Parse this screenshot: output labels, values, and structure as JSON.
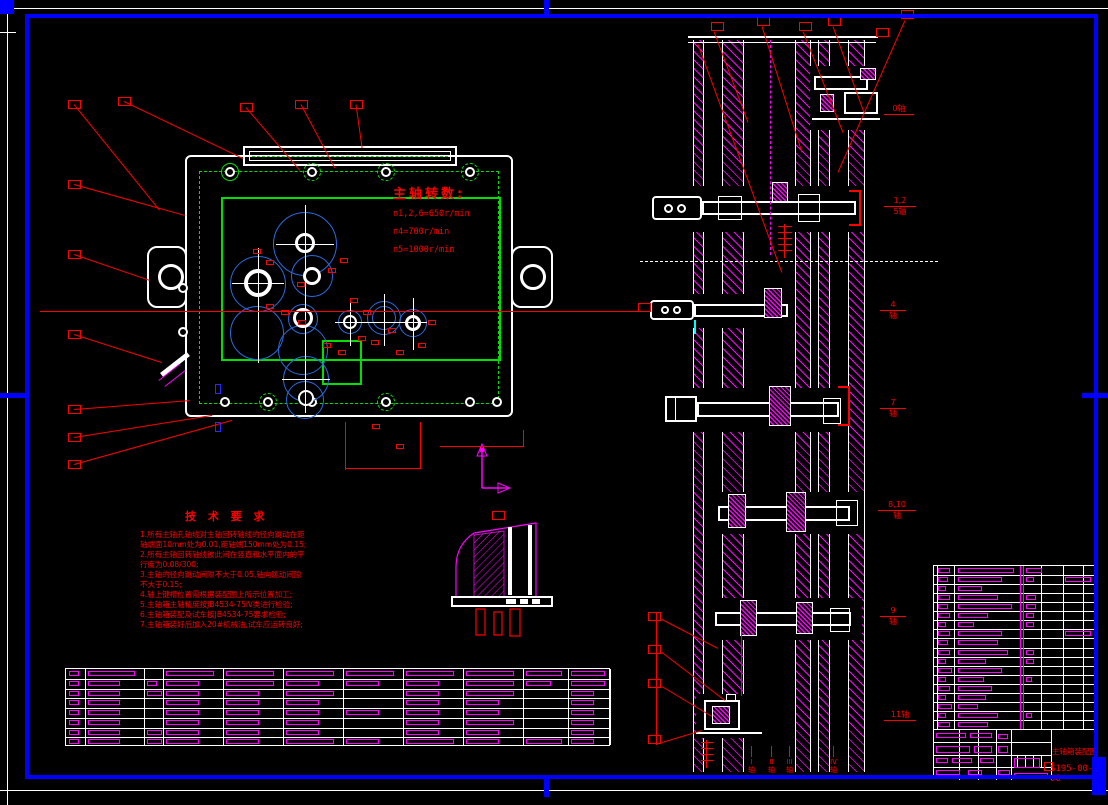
{
  "plan_view": {
    "speed_note": {
      "title": "主轴转数:",
      "lines": [
        "n1,2,6=650r/min",
        "n4=700r/min",
        "n5=1000r/min"
      ]
    }
  },
  "notes": {
    "title": "技 术 要 求",
    "lines": [
      "1.所有主轴孔轴线对主轴回转轴线的径向跳动在距",
      "轴端面10mm处为0.01,距轴端150mm处为0.15;",
      "2.所有主轴回转轴线彼此间在竖直和水平面内的平",
      "行度为0.08/300;",
      "3.主轴的径向跳动间隙不大于0.05,轴向跳动间隙",
      "不大于0.15;",
      "4.轴上键槽位置需根据装配图上所示位置加工;",
      "5.主轴箱主轴精度按JB4534-75Ⅳ类进行检验;",
      "6.主轴箱装配及试车按JB4534-75要求检验;",
      "7.主轴箱装好后加入20#机械油,试车应运转良好;"
    ]
  },
  "section_view": {
    "shaft_labels": [
      {
        "text": "0轴"
      },
      {
        "upper": "1,2",
        "lower": "5轴"
      },
      {
        "upper": "4",
        "lower": "轴"
      },
      {
        "upper": "7",
        "lower": "轴"
      },
      {
        "upper": "8,10",
        "lower": "轴"
      },
      {
        "upper": "9",
        "lower": "轴"
      },
      {
        "text": "11轴"
      }
    ],
    "bottom_labels": [
      {
        "num": "I",
        "word": "轴"
      },
      {
        "num": "II",
        "word": "轴"
      },
      {
        "num": "III",
        "word": "轴"
      },
      {
        "num": "IV",
        "word": "轴"
      }
    ]
  },
  "title_block": {
    "name": "主轴箱装配图",
    "number": "S195-00-00"
  },
  "colors": {
    "frame": "#0000ff",
    "outline": "#ffffff",
    "annotation": "#ff0000",
    "housing": "#00e000",
    "gears": "#2a6adf",
    "hatch": "#ff00ff",
    "highlight": "#00ffff"
  },
  "bom_table": {
    "rows": [
      [
        12,
        56,
        16,
        0
      ],
      [
        10,
        44,
        8,
        26
      ],
      [
        8,
        24,
        0,
        0
      ],
      [
        12,
        40,
        10,
        0
      ],
      [
        10,
        54,
        10,
        0
      ],
      [
        12,
        30,
        8,
        0
      ],
      [
        8,
        16,
        8,
        0
      ],
      [
        12,
        44,
        0,
        26
      ],
      [
        10,
        40,
        0,
        0
      ],
      [
        12,
        50,
        8,
        0
      ],
      [
        8,
        28,
        8,
        0
      ],
      [
        14,
        44,
        0,
        0
      ],
      [
        8,
        26,
        6,
        0
      ],
      [
        12,
        34,
        0,
        0
      ],
      [
        8,
        28,
        0,
        0
      ],
      [
        14,
        20,
        0,
        0
      ],
      [
        8,
        40,
        6,
        0
      ],
      [
        12,
        30,
        0,
        0
      ]
    ]
  },
  "parts_table": {
    "pattern": [
      [
        1,
        2,
        0,
        2,
        2,
        2,
        2,
        2,
        2,
        2,
        2
      ],
      [
        1,
        1,
        1,
        1,
        2,
        1,
        1,
        1,
        2,
        1,
        2
      ],
      [
        1,
        1,
        2,
        1,
        1,
        2,
        0,
        1,
        2,
        0,
        1
      ],
      [
        1,
        1,
        0,
        1,
        1,
        1,
        0,
        1,
        1,
        0,
        1
      ],
      [
        1,
        1,
        0,
        1,
        1,
        1,
        1,
        1,
        1,
        0,
        1
      ],
      [
        1,
        1,
        0,
        1,
        1,
        1,
        0,
        1,
        2,
        0,
        1
      ],
      [
        1,
        1,
        2,
        1,
        1,
        1,
        0,
        1,
        1,
        0,
        1
      ],
      [
        1,
        1,
        2,
        1,
        1,
        2,
        1,
        2,
        1,
        2,
        1
      ]
    ]
  }
}
